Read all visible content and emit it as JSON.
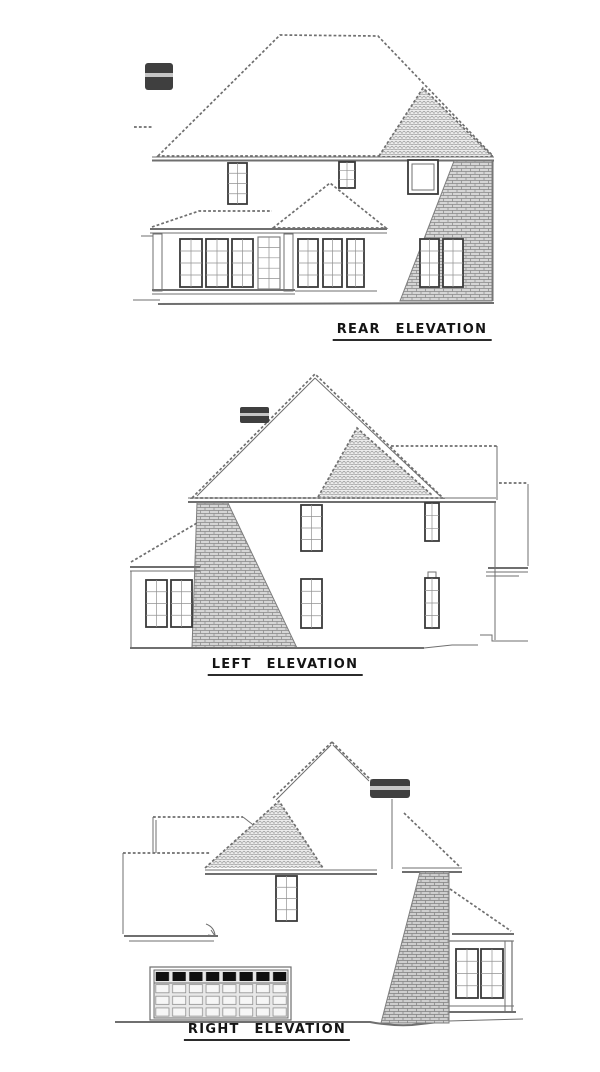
{
  "elevations": [
    {
      "id": "rear",
      "label": "REAR ELEVATION"
    },
    {
      "id": "left",
      "label": "LEFT ELEVATION"
    },
    {
      "id": "right",
      "label": "RIGHT ELEVATION"
    }
  ],
  "colors": {
    "line": "#6f6f6f",
    "dark_line": "#3a3a3a",
    "brick_fill": "#d6d6d6",
    "brick_line": "#868686",
    "shingle_fill": "#ededed",
    "shingle_line": "#8f8f8f",
    "chimney_cap": "#3f3f3f",
    "chimney_band": "#c6c6c6",
    "garage_panel": "#101010",
    "label_text": "#141414",
    "paper": "#ffffff"
  }
}
